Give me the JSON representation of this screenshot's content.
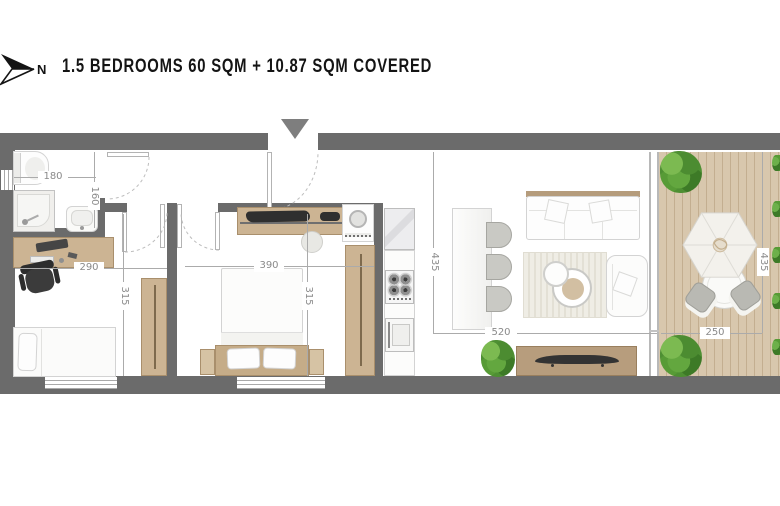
{
  "title": "1.5 BEDROOMS 60 SQM + 10.87 SQM COVERED",
  "compass": {
    "label": "N"
  },
  "dimensions": {
    "bathroom_width": "180",
    "bathroom_depth": "160",
    "study_width": "290",
    "study_depth": "315",
    "bedroom_width": "390",
    "bedroom_depth": "315",
    "living_depth": "435",
    "living_width": "520",
    "terrace_depth": "435",
    "terrace_width": "250"
  },
  "colors": {
    "wall": "#6b6b6b",
    "wood": "#ccb493",
    "deck": "#d8c7ad",
    "plant_green": "#579b36",
    "dimension_text": "#8a8a8a",
    "title_text": "#141414"
  }
}
